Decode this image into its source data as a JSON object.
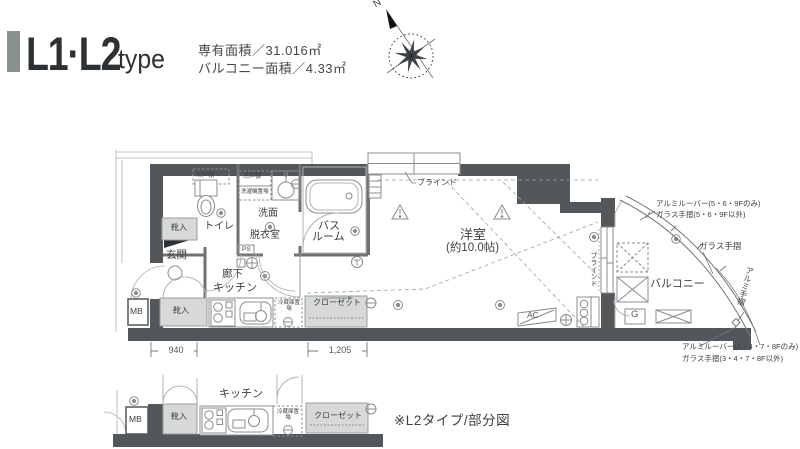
{
  "header": {
    "title": "L1·L2",
    "title_suffix": "type",
    "area1": "専有面積／31.016㎡",
    "area2": "バルコニー面積／4.33㎡",
    "compass_n": "N"
  },
  "colors": {
    "accent": "#8a918b",
    "wall": "#54575a"
  },
  "plan": {
    "yoshitsu": "洋室",
    "yoshitsu_size": "(約10.0帖)",
    "balcony": "バルコニー",
    "genkan": "玄関",
    "toilet": "トイレ",
    "senmen1": "洗面",
    "senmen2": "脱衣室",
    "bath1": "バス",
    "bath2": "ルーム",
    "rouka": "廊下",
    "kitchen": "キッチン",
    "kutsuire_upper": "靴入",
    "kutsuire_lower": "靴入",
    "closet": "クローゼット",
    "fridge": "冷蔵庫置場",
    "washer": "洗濯機置場",
    "tsurito1": "吊戸棚",
    "tsurito2": "吊戸棚",
    "mb": "MB",
    "ps": "PS",
    "ac": "AC",
    "g": "G",
    "blind_top": "ブラインド",
    "blind_side": "ブラインド",
    "dim_940": "940",
    "dim_1205": "1,205",
    "ann_top1": "アルミルーバー(5・6・9Fのみ)",
    "ann_top2": "ガラス手摺(5・6・9F以外)",
    "ann_mid": "ガラス手摺",
    "ann_side": "アルミ手摺",
    "ann_bot1": "アルミルーバー(3・4・7・8Fのみ)",
    "ann_bot2": "ガラス手摺(3・4・7・8F以外)"
  },
  "partial": {
    "mb": "MB",
    "kutsuire": "靴入",
    "kitchen": "キッチン",
    "fridge": "冷蔵庫置場",
    "closet": "クローゼット",
    "caption": "※L2タイプ/部分図"
  }
}
